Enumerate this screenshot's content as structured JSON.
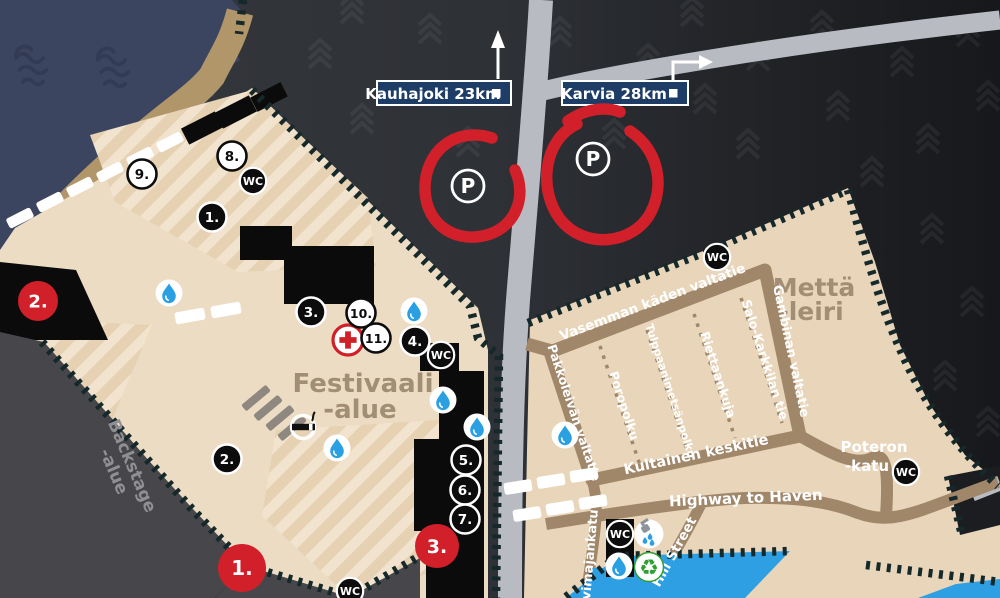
{
  "map": {
    "signs": {
      "kauhajoki": "Kauhajoki 23km",
      "karvia": "Karvia 28km"
    },
    "areas": {
      "festival_line1": "Festivaali",
      "festival_line2": "-alue",
      "camp_line1": "Mettä",
      "camp_line2": "-leiri",
      "backstage_line1": "Backstage",
      "backstage_line2": "-alue"
    },
    "streets": {
      "vasemman": "Vasemman käden valtatie",
      "gambinan": "Gambinan valtatie",
      "pakkoleivan": "Pakkoleivän valtatie",
      "kultainen": "Kultainen keskitie",
      "poropolku": "Poropolku",
      "tulppaani": "Tulppaanimetsänpolku",
      "riettaankuja": "Riettaankuja",
      "salo": "Salo-Karkkilan tie",
      "highway": "Highway to Haven",
      "hill": "Hill Street",
      "vimaja": "vimajankatu",
      "poteron_line1": "Poteron",
      "poteron_line2": "-katu"
    },
    "markers": {
      "black": [
        "1.",
        "2.",
        "3.",
        "4.",
        "5.",
        "6.",
        "7."
      ],
      "white": [
        "8.",
        "9.",
        "10.",
        "11."
      ],
      "red": [
        "1.",
        "2.",
        "3."
      ]
    },
    "icons": {
      "wc_label": "WC",
      "parking_label": "P",
      "recycle_glyph": "♻",
      "water_point": "water-drop",
      "first_aid": "first-aid-cross",
      "smoking": "smoking-area",
      "shower": "shower",
      "trees": "forest-chevron-tree",
      "waves": "sea-waves"
    },
    "colors": {
      "water": "#3b4560",
      "forest": "#35383d",
      "forest_dark": "#1a1c1f",
      "beach": "#b1966a",
      "festival_area": "#ecdcc3",
      "camp_area": "#e8d5ba",
      "backstage_gray": "#47474b",
      "road_major": "#b8bcc2",
      "road_camp": "#a1876a",
      "fence": "#15282a",
      "stage_black": "#0b0b0b",
      "pool_blue": "#2d9fe2",
      "marker_red": "#d2202a",
      "sign_blue": "#1d3c66",
      "area_label": "#a18e74"
    }
  }
}
